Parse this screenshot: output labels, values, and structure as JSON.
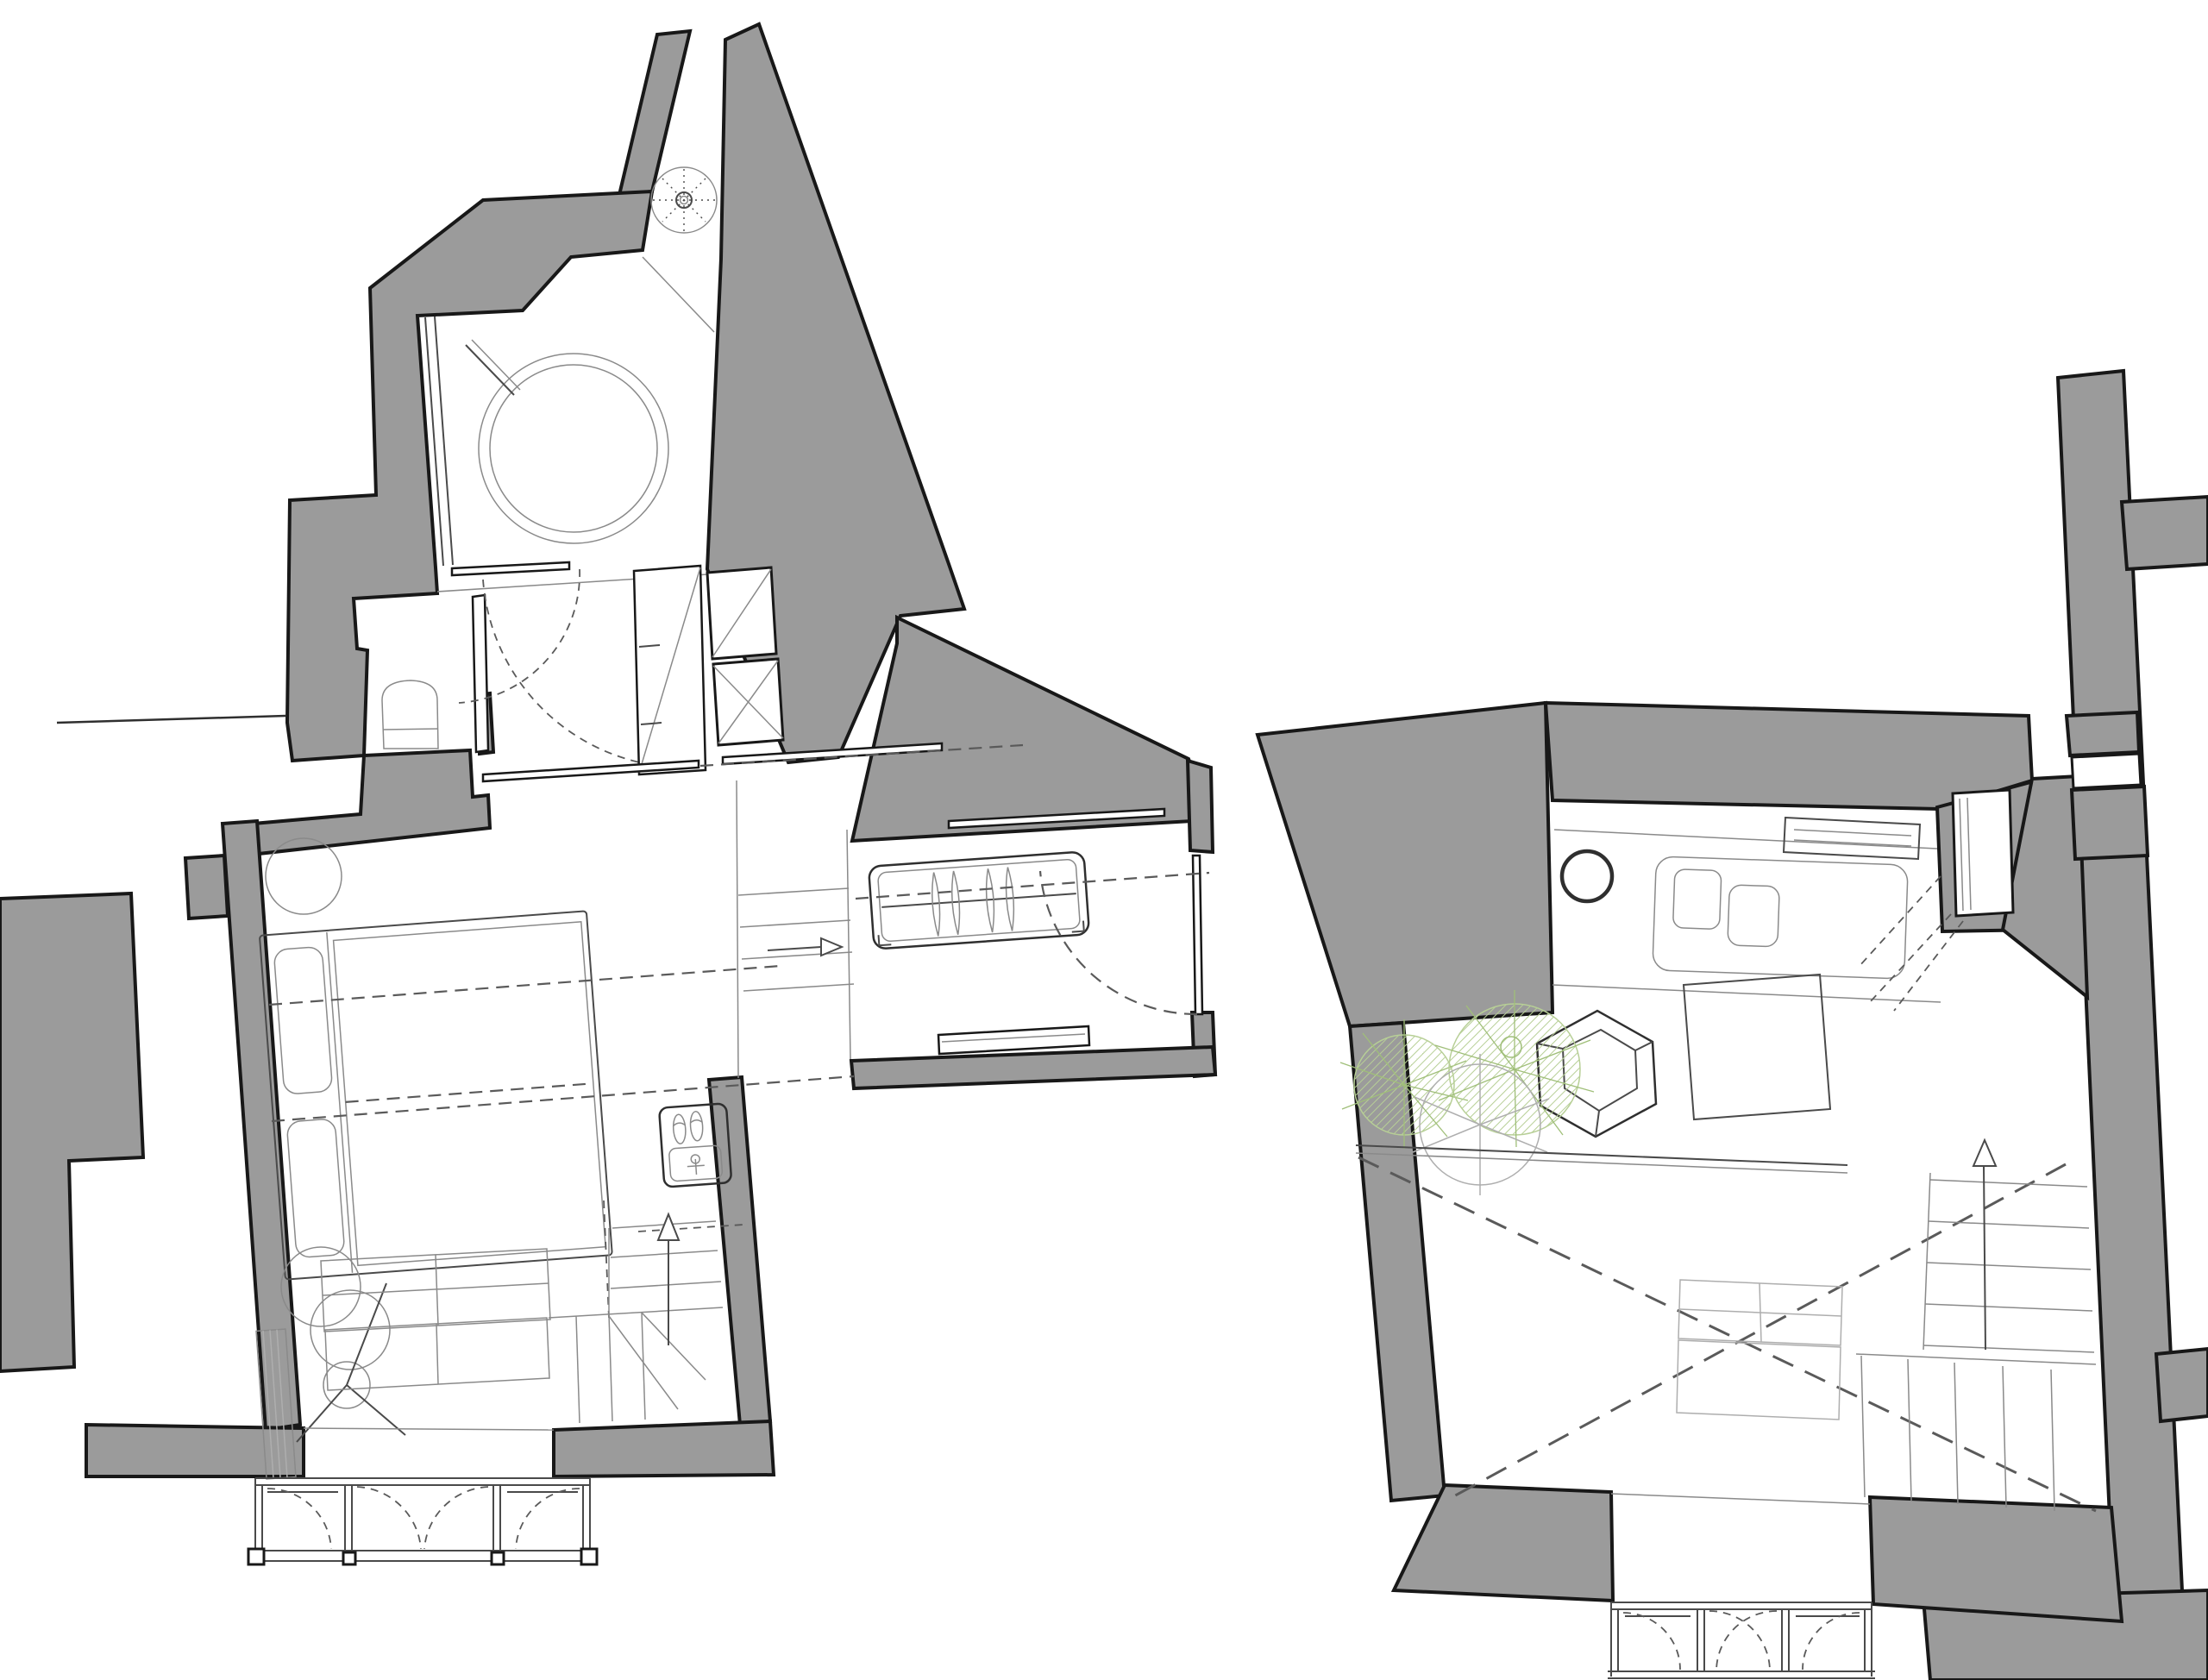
{
  "document": {
    "kind": "architectural-floor-plan-sheet",
    "views": [
      {
        "id": "lower-floor-plan",
        "elements": [
          "shower-room",
          "floor-drain",
          "round-bathtub",
          "towel-bar",
          "wc",
          "toilet",
          "bathroom-door",
          "dressing-area",
          "tall-wardrobe",
          "duct-closets",
          "sliding-door-track",
          "bedroom",
          "double-bed",
          "pillows",
          "bedside-table",
          "nesting-side-tables",
          "radiator",
          "tripod-floor-lamp",
          "shelving-unit",
          "l-shaped-staircase",
          "up-arrow",
          "washbasin-vanity",
          "slippers",
          "landing-steps",
          "direction-arrow",
          "entrance-hall",
          "coat-rack",
          "clothes-hangers",
          "entry-door",
          "door-swing",
          "doormat",
          "bay-window-balcony",
          "window-swing-arcs",
          "neighbour-walls"
        ]
      },
      {
        "id": "upper-floor-plan",
        "elements": [
          "kitchen-counter",
          "round-basin",
          "double-sink-block",
          "wall-shelf",
          "window-niche",
          "window-opening-dashes",
          "dining-table",
          "faceted-stool",
          "potted-plants",
          "glass-balustrade",
          "double-height-void",
          "void-cross-dashes",
          "lower-shelving-seen-through-void",
          "l-shaped-staircase",
          "up-arrow",
          "balcony-french-windows",
          "neighbour-walls"
        ]
      }
    ]
  },
  "colors": {
    "background": "#ffffff",
    "wall_fill": "#9b9b9b",
    "wall_outline": "#181818",
    "line_strong": "#2f2f2f",
    "line_medium": "#4a4a4a",
    "line_light": "#8a8a8a",
    "line_faint": "#aeaeae",
    "dash": "#5a5a5a",
    "plant_hatch": "#b7cf96",
    "plant_spoke": "#a0bf79"
  }
}
